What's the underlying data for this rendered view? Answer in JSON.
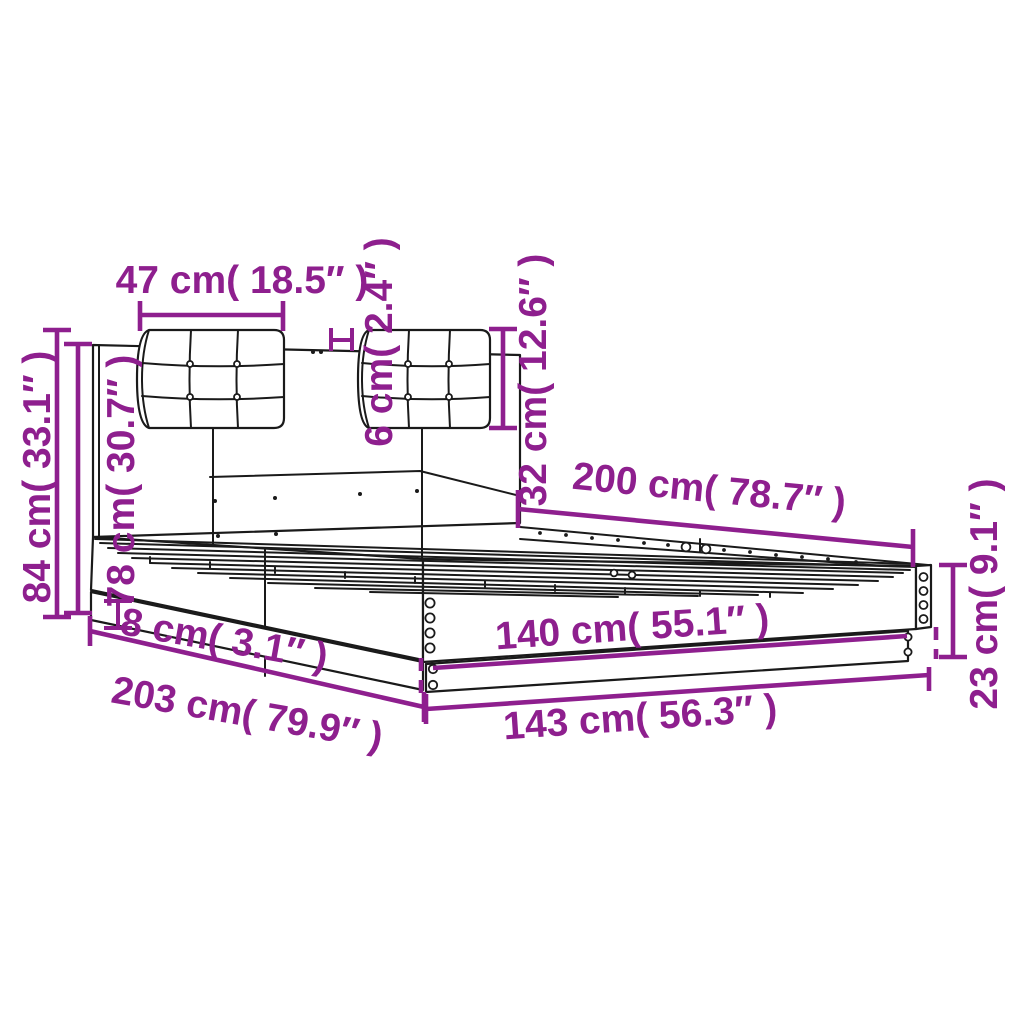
{
  "colors": {
    "background": "#ffffff",
    "dimension_accent": "#8e1f8e",
    "drawing_line": "#1a1a1a"
  },
  "diagram": {
    "dimensions": {
      "cushion_width": {
        "label": "47 cm( 18.5″ )",
        "cm": 47,
        "in": 18.5
      },
      "cushion_gap": {
        "label": "6 cm( 2.4″ )",
        "cm": 6,
        "in": 2.4
      },
      "cushion_height": {
        "label": "32 cm( 12.6″ )",
        "cm": 32,
        "in": 12.6
      },
      "inner_length": {
        "label": "200 cm( 78.7″ )",
        "cm": 200,
        "in": 78.7
      },
      "total_height": {
        "label": "84 cm( 33.1″ )",
        "cm": 84,
        "in": 33.1
      },
      "headboard_height": {
        "label": "78 cm( 30.7″ )",
        "cm": 78,
        "in": 30.7
      },
      "base_trim_height": {
        "label": "8 cm( 3.1″ )",
        "cm": 8,
        "in": 3.1
      },
      "total_length": {
        "label": "203 cm( 79.9″ )",
        "cm": 203,
        "in": 79.9
      },
      "inner_width": {
        "label": "140 cm( 55.1″ )",
        "cm": 140,
        "in": 55.1
      },
      "outer_width": {
        "label": "143 cm( 56.3″ )",
        "cm": 143,
        "in": 56.3
      },
      "foot_height": {
        "label": "23 cm( 9.1″ )",
        "cm": 23,
        "in": 9.1
      }
    }
  }
}
